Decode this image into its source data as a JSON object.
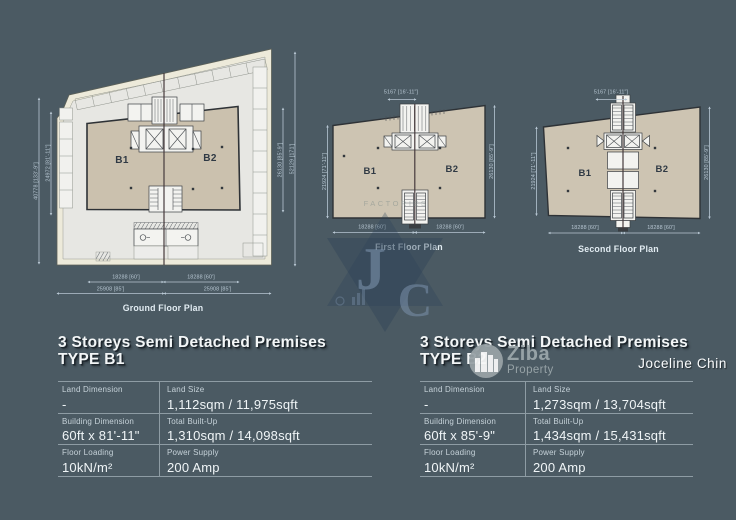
{
  "page": {
    "background": "#4b5a63"
  },
  "plans": {
    "ground": {
      "caption": "Ground Floor Plan",
      "unit_left": "B1",
      "unit_right": "B2",
      "dim_left_outer": "40778 [133'-9\"]",
      "dim_left_inner": "24972 [81'-11\"]",
      "dim_right_inner": "26130 [85'-9\"]",
      "dim_right_outer": "52129 [171']",
      "dim_bottom_b1": "18288 [60']",
      "dim_bottom_b2": "18288 [60']",
      "dim_bottom_b1_outer": "25908 [85']",
      "dim_bottom_b2_outer": "25908 [85']"
    },
    "first": {
      "caption": "First Floor Plan",
      "unit_left": "B1",
      "unit_right": "B2",
      "dim_top": "5167 [16'-11\"]",
      "dim_left": "21924 [71'-11\"]",
      "dim_right": "26130 [85'-9\"]",
      "dim_bottom_b1": "18288 [60']",
      "dim_bottom_b2": "18288 [60']",
      "watermark": "FACTORIES"
    },
    "second": {
      "caption": "Second Floor Plan",
      "unit_left": "B1",
      "unit_right": "B2",
      "dim_top": "5167 [16'-11\"]",
      "dim_left": "21924 [71'-11\"]",
      "dim_right": "26130 [85'-9\"]",
      "dim_bottom_b1": "18288 [60']",
      "dim_bottom_b2": "18288 [60']"
    }
  },
  "watermarks": {
    "jc_j": "J",
    "jc_c": "C",
    "ziba_name": "Ziba",
    "ziba_subtitle": "Property",
    "agent_name": "Joceline Chin"
  },
  "specs": {
    "b1": {
      "title": "3 Storeys Semi Detached Premises",
      "type_label": "TYPE B1",
      "rows": [
        {
          "c1_label": "Land Dimension",
          "c1_value": "-",
          "c2_label": "Land Size",
          "c2_value": "1,112sqm / 11,975sqft"
        },
        {
          "c1_label": "Building Dimension",
          "c1_value": "60ft x 81'-11\"",
          "c2_label": "Total Built-Up",
          "c2_value": "1,310sqm / 14,098sqft"
        },
        {
          "c1_label": "Floor Loading",
          "c1_value": "10kN/m²",
          "c2_label": "Power Supply",
          "c2_value": "200 Amp"
        }
      ]
    },
    "b2": {
      "title": "3 Storeys Semi Detached Premises",
      "type_label": "TYPE B2",
      "rows": [
        {
          "c1_label": "Land Dimension",
          "c1_value": "-",
          "c2_label": "Land Size",
          "c2_value": "1,273sqm / 13,704sqft"
        },
        {
          "c1_label": "Building Dimension",
          "c1_value": "60ft x 85'-9\"",
          "c2_label": "Total Built-Up",
          "c2_value": "1,434sqm / 15,431sqft"
        },
        {
          "c1_label": "Floor Loading",
          "c1_value": "10kN/m²",
          "c2_label": "Power Supply",
          "c2_value": "200 Amp"
        }
      ]
    }
  },
  "colors": {
    "dimension": "#b7c6d2",
    "site_fill": "#edeada",
    "building_fill": "#cdc4b2",
    "background": "#4b5a63"
  }
}
